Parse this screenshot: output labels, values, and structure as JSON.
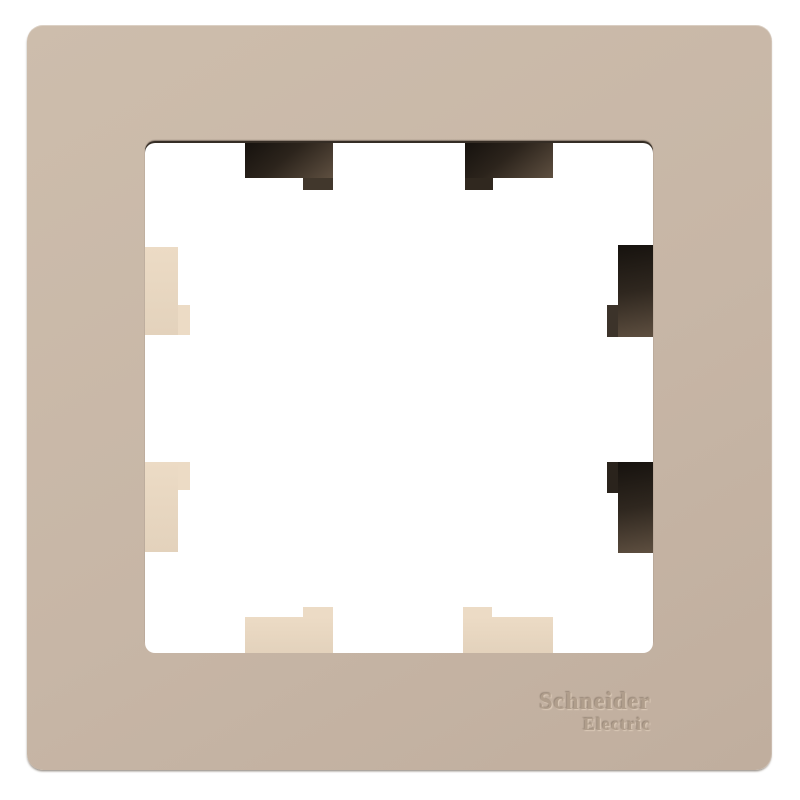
{
  "product": {
    "description": "Beige single-gang decorative wall-plate frame product photo",
    "brand": {
      "line1": "Schneider",
      "line2": "Electric"
    }
  },
  "colors": {
    "background": "#ffffff",
    "frame": "#c7b6a6",
    "frame_light": "#cdbdac",
    "frame_dark": "#c0ae9e",
    "opening": "#ffffff",
    "inner_edge": "#352d25",
    "clip_light": "#ecdbc5",
    "clip_light_dark": "#e3d2bc",
    "clip_dark_a": "#16120e",
    "clip_dark_b": "#5e4f40",
    "logo_ink": "#b09e8c",
    "logo_highlight": "#dccbb9"
  }
}
